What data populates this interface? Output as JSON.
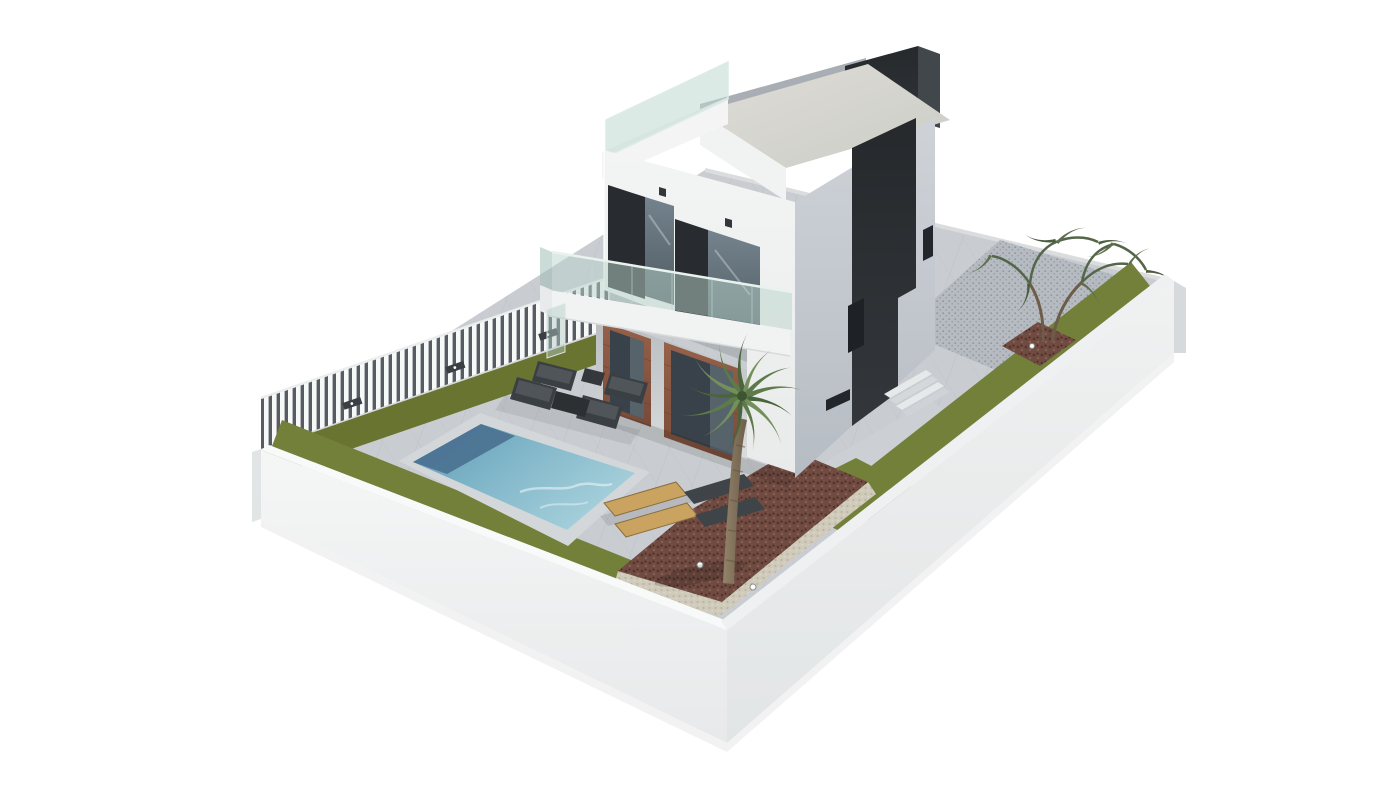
{
  "scene": {
    "kind": "architectural-3d-render",
    "subject": "modern-three-storey-villa-with-pool-and-walled-garden",
    "background": "#ffffff"
  },
  "palette": {
    "background": "#ffffff",
    "wallWhiteTop": "#f5f6f6",
    "wallWhiteBottom": "#e7e9ea",
    "wallRightTop": "#f0f1f1",
    "wallRightBottom": "#e2e5e6",
    "wallCap": "#f8f9f9",
    "wallCapRight": "#eef0f1",
    "wallEnd": "#d7dadc",
    "pavement": "#c9cdd1",
    "pavementShade": "#b5bbc1",
    "walkway": "#ccd0d4",
    "curb": "#dadcdd",
    "grass": "#72803a",
    "grassDark": "#68742f",
    "mulch": "#6f4b42",
    "mulchDark": "#54342c",
    "mulchLight": "#8a5e52",
    "gravel": "#cfcaba",
    "gravelDot": "#b7b2a2",
    "poolLight": "#a6d0db",
    "poolMid": "#7fb5c8",
    "poolDeep": "#5e97b3",
    "poolShadow": "#4a7090",
    "poolCoping": "#d3d7d9",
    "houseFrontTop": "#f3f4f4",
    "houseFrontBottom": "#e9ebeb",
    "houseSideTop": "#ced3d8",
    "houseSideBottom": "#b6bcc3",
    "deckTop": "#dedcd6",
    "deckBottom": "#cccdc7",
    "parapetGray": "#a8aeb4",
    "darkTop": "#26292c",
    "darkBottom": "#33373b",
    "darkRightFace": "#42474c",
    "windowPanel": "#282b2f",
    "windowGlassTop": "#74838d",
    "windowGlassBottom": "#4e5a62",
    "doorGlass": "#39424a",
    "doorGlassReflect": "#57636b",
    "brickTop": "#96614a",
    "brickBottom": "#774a38",
    "recessTop": "#b9bdbf",
    "recessBottom": "#dadcdd",
    "fenceSlat": "#f7f8f8",
    "fenceGap": "#565c62",
    "fencePost": "#3b3f43",
    "furnitureDark": "#3a3f43",
    "furnitureSeat": "#50555a",
    "tableDark": "#2c3033",
    "loungerWood": "#c9a35f",
    "loungerDark": "#3f4448",
    "trunkLight": "#93836a",
    "trunkDark": "#6d5e49",
    "palmGreen": "#5d7a4a",
    "palmDark": "#4a653c",
    "palmLight": "#73905a",
    "olive": "#5e6f4e",
    "oliveDark": "#4c5c3e",
    "lampDark": "#33373b",
    "lightDot": "#fcfcfc"
  },
  "objects": {
    "villa": "three-storey white villa with dark stair tower",
    "roofTerrace": "roof terrace with glass balustrade",
    "balcony": "first-floor balcony with glass railing",
    "pool": "rectangular swimming pool",
    "loungers": {
      "wooden": 2,
      "dark": 2
    },
    "sofaSet": {
      "chairs": 4,
      "tables": 2
    },
    "palms": 1,
    "oliveTrees": 1,
    "groundLights": 3,
    "fencePosts": 3
  }
}
